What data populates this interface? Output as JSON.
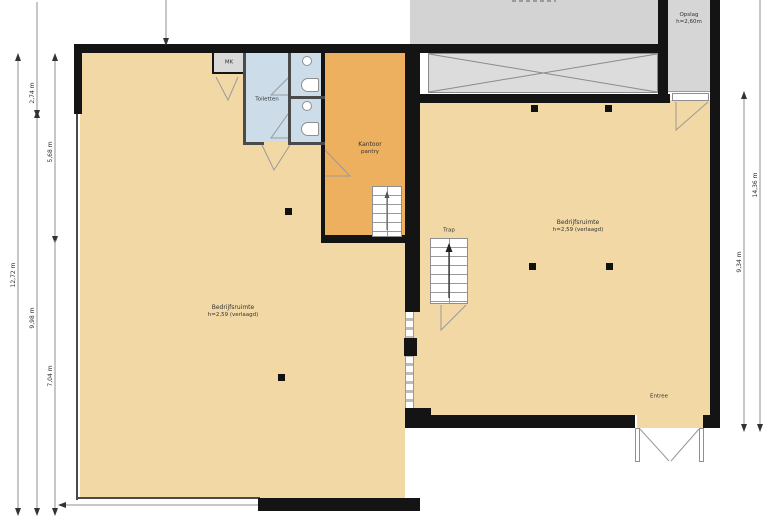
{
  "plan": {
    "rooms": {
      "left_hall": {
        "label": "Bedrijfsruimte",
        "note": "h=2,59 (verlaagd)"
      },
      "right_hall": {
        "label": "Bedrijfsruimte",
        "note": "h=2,59 (verlaagd)"
      },
      "kantoor": {
        "label": "Kantoor",
        "note": "pantry"
      },
      "toiletten": {
        "label": "Toiletten"
      },
      "mk": {
        "label": "MK"
      },
      "opslag": {
        "label": "Opslag",
        "note": "h=2,60m"
      },
      "trap": {
        "label": "Trap"
      },
      "entree": {
        "label": "Entree"
      }
    },
    "dimensions": {
      "left_outer_total": "12,72 m",
      "left_mid_top": "2,74 m",
      "left_mid_bottom": "9,98 m",
      "left_inner_top": "5,68 m",
      "left_inner_bottom": "7,04 m",
      "right_inner": "9,34 m",
      "right_outer": "14,36 m"
    },
    "colors": {
      "room_fill": "#f2d8a5",
      "office_fill": "#edb05e",
      "wet_fill": "#ccdde9",
      "storage_fill": "#d3d3d3",
      "wall": "#141414"
    }
  }
}
